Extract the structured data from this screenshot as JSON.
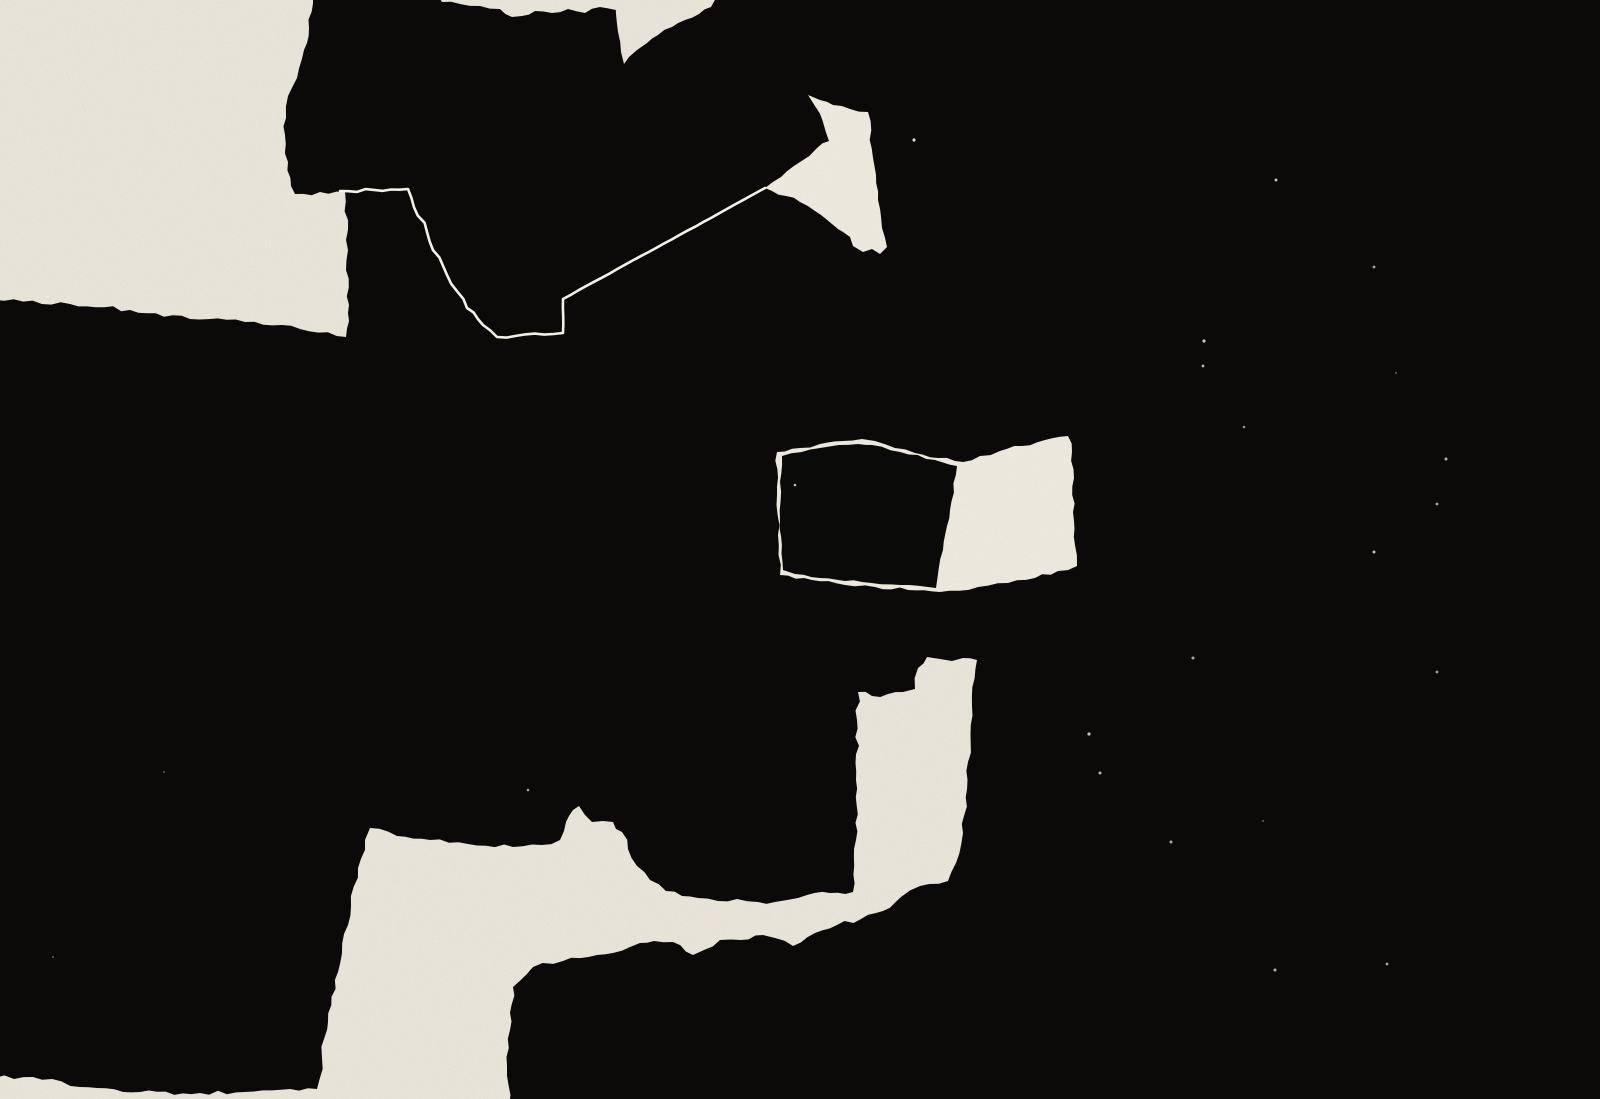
{
  "meta": {
    "title": "Abstract collage — black ink and torn cream paper",
    "canvas_width": 1600,
    "canvas_height": 1099
  },
  "artwork": {
    "background": "#0b0a08",
    "colors": {
      "cream": "#eae6db",
      "cream_bright": "#efebe0",
      "seam": "#f3f0e7",
      "ink": "#0a0a08"
    },
    "shapes": [
      {
        "name": "paper-field-top-left",
        "kind": "polygon",
        "fill": "cream",
        "rough": 2.2,
        "points": [
          [
            -5,
            -5
          ],
          [
            313,
            -5
          ],
          [
            309,
            28
          ],
          [
            304,
            50
          ],
          [
            297,
            78
          ],
          [
            288,
            96
          ],
          [
            286,
            118
          ],
          [
            285,
            135
          ],
          [
            288,
            162
          ],
          [
            291,
            186
          ],
          [
            295,
            194
          ],
          [
            345,
            192
          ],
          [
            348,
            230
          ],
          [
            346,
            270
          ],
          [
            349,
            305
          ],
          [
            346,
            337
          ],
          [
            300,
            329
          ],
          [
            245,
            322
          ],
          [
            190,
            319
          ],
          [
            130,
            310
          ],
          [
            70,
            304
          ],
          [
            -5,
            300
          ]
        ]
      },
      {
        "name": "paper-sliver-top",
        "kind": "polygon",
        "fill": "cream",
        "rough": 1.5,
        "points": [
          [
            438,
            -5
          ],
          [
            619,
            -5
          ],
          [
            616,
            10
          ],
          [
            600,
            7
          ],
          [
            585,
            13
          ],
          [
            568,
            9
          ],
          [
            552,
            13
          ],
          [
            535,
            11
          ],
          [
            522,
            16
          ],
          [
            512,
            17
          ],
          [
            500,
            9
          ],
          [
            480,
            6
          ],
          [
            460,
            4
          ],
          [
            442,
            2
          ]
        ]
      },
      {
        "name": "paper-notch-wedge",
        "kind": "polygon",
        "fill": "cream",
        "rough": 1.3,
        "points": [
          [
            614,
            -5
          ],
          [
            720,
            -5
          ],
          [
            711,
            7
          ],
          [
            699,
            14
          ],
          [
            685,
            20
          ],
          [
            672,
            27
          ],
          [
            658,
            35
          ],
          [
            647,
            43
          ],
          [
            637,
            50
          ],
          [
            629,
            57
          ],
          [
            624,
            64
          ],
          [
            621,
            52
          ],
          [
            618,
            32
          ],
          [
            616,
            14
          ]
        ]
      },
      {
        "name": "arrow-head-paper",
        "kind": "polygon",
        "fill": "cream_bright",
        "rough": 1.6,
        "points": [
          [
            808,
            95
          ],
          [
            820,
            100
          ],
          [
            833,
            105
          ],
          [
            850,
            109
          ],
          [
            868,
            112
          ],
          [
            873,
            158
          ],
          [
            878,
            200
          ],
          [
            882,
            228
          ],
          [
            887,
            247
          ],
          [
            880,
            254
          ],
          [
            872,
            249
          ],
          [
            863,
            252
          ],
          [
            853,
            246
          ],
          [
            850,
            237
          ],
          [
            838,
            229
          ],
          [
            826,
            219
          ],
          [
            815,
            211
          ],
          [
            800,
            202
          ],
          [
            786,
            196
          ],
          [
            772,
            191
          ],
          [
            765,
            188
          ],
          [
            781,
            177
          ],
          [
            800,
            162
          ],
          [
            817,
            148
          ],
          [
            829,
            141
          ],
          [
            823,
            122
          ],
          [
            815,
            106
          ]
        ]
      },
      {
        "name": "paper-middle-piece",
        "kind": "polygon",
        "fill": "cream_bright",
        "rough": 1.8,
        "points": [
          [
            777,
            452
          ],
          [
            800,
            448
          ],
          [
            820,
            444
          ],
          [
            843,
            441
          ],
          [
            862,
            439
          ],
          [
            875,
            441
          ],
          [
            895,
            448
          ],
          [
            915,
            453
          ],
          [
            938,
            458
          ],
          [
            955,
            461
          ],
          [
            963,
            462
          ],
          [
            980,
            456
          ],
          [
            1000,
            451
          ],
          [
            1022,
            446
          ],
          [
            1045,
            440
          ],
          [
            1068,
            436
          ],
          [
            1072,
            452
          ],
          [
            1074,
            478
          ],
          [
            1073,
            512
          ],
          [
            1075,
            545
          ],
          [
            1077,
            566
          ],
          [
            1058,
            571
          ],
          [
            1035,
            578
          ],
          [
            1008,
            583
          ],
          [
            978,
            587
          ],
          [
            940,
            592
          ],
          [
            908,
            590
          ],
          [
            875,
            587
          ],
          [
            845,
            585
          ],
          [
            812,
            580
          ],
          [
            780,
            575
          ],
          [
            778,
            535
          ],
          [
            777,
            495
          ]
        ]
      },
      {
        "name": "ink-block-middle",
        "kind": "polygon",
        "fill": "ink",
        "rough": 1.1,
        "points": [
          [
            782,
            456
          ],
          [
            820,
            448
          ],
          [
            858,
            444
          ],
          [
            872,
            445
          ],
          [
            900,
            452
          ],
          [
            935,
            460
          ],
          [
            957,
            466
          ],
          [
            950,
            510
          ],
          [
            943,
            550
          ],
          [
            936,
            588
          ],
          [
            900,
            585
          ],
          [
            862,
            582
          ],
          [
            820,
            578
          ],
          [
            795,
            574
          ],
          [
            783,
            570
          ],
          [
            780,
            520
          ],
          [
            780,
            482
          ]
        ]
      },
      {
        "name": "paper-bottom-mass",
        "kind": "polygon",
        "fill": "cream",
        "rough": 2.4,
        "points": [
          [
            370,
            828
          ],
          [
            397,
            836
          ],
          [
            430,
            840
          ],
          [
            468,
            844
          ],
          [
            513,
            847
          ],
          [
            542,
            845
          ],
          [
            560,
            840
          ],
          [
            566,
            822
          ],
          [
            573,
            810
          ],
          [
            579,
            806
          ],
          [
            585,
            815
          ],
          [
            592,
            822
          ],
          [
            603,
            821
          ],
          [
            613,
            822
          ],
          [
            616,
            829
          ],
          [
            622,
            832
          ],
          [
            628,
            849
          ],
          [
            637,
            866
          ],
          [
            650,
            880
          ],
          [
            666,
            891
          ],
          [
            682,
            896
          ],
          [
            698,
            898
          ],
          [
            718,
            901
          ],
          [
            737,
            899
          ],
          [
            758,
            902
          ],
          [
            775,
            902
          ],
          [
            787,
            900
          ],
          [
            798,
            898
          ],
          [
            807,
            895
          ],
          [
            830,
            893
          ],
          [
            853,
            892
          ],
          [
            856,
            840
          ],
          [
            856,
            780
          ],
          [
            857,
            720
          ],
          [
            858,
            692
          ],
          [
            872,
            696
          ],
          [
            888,
            694
          ],
          [
            903,
            692
          ],
          [
            915,
            689
          ],
          [
            918,
            668
          ],
          [
            927,
            657
          ],
          [
            940,
            659
          ],
          [
            952,
            661
          ],
          [
            963,
            658
          ],
          [
            977,
            660
          ],
          [
            972,
            706
          ],
          [
            968,
            762
          ],
          [
            963,
            833
          ],
          [
            956,
            863
          ],
          [
            948,
            881
          ],
          [
            920,
            886
          ],
          [
            901,
            897
          ],
          [
            883,
            911
          ],
          [
            861,
            919
          ],
          [
            837,
            925
          ],
          [
            815,
            933
          ],
          [
            793,
            946
          ],
          [
            775,
            938
          ],
          [
            763,
            935
          ],
          [
            741,
            940
          ],
          [
            720,
            940
          ],
          [
            704,
            950
          ],
          [
            693,
            955
          ],
          [
            673,
            942
          ],
          [
            654,
            941
          ],
          [
            640,
            943
          ],
          [
            630,
            947
          ],
          [
            597,
            955
          ],
          [
            563,
            961
          ],
          [
            533,
            967
          ],
          [
            513,
            987
          ],
          [
            510,
            1030
          ],
          [
            507,
            1066
          ],
          [
            509,
            1105
          ],
          [
            -5,
            1105
          ],
          [
            -5,
            1078
          ],
          [
            33,
            1077
          ],
          [
            80,
            1087
          ],
          [
            140,
            1092
          ],
          [
            200,
            1093
          ],
          [
            245,
            1092
          ],
          [
            290,
            1089
          ],
          [
            317,
            1089
          ],
          [
            322,
            1058
          ],
          [
            325,
            1036
          ],
          [
            328,
            1022
          ],
          [
            338,
            972
          ],
          [
            348,
            925
          ],
          [
            358,
            868
          ],
          [
            365,
            840
          ]
        ]
      },
      {
        "name": "seam-outline-line",
        "kind": "polyline",
        "stroke": "seam",
        "width": 2.6,
        "rough": 1.2,
        "edges": [
          1.5,
          2.5,
          2.5,
          2.5,
          2.2,
          1.8,
          1.2,
          0.5,
          0.3
        ],
        "points": [
          [
            340,
            191
          ],
          [
            408,
            189
          ],
          [
            427,
            232
          ],
          [
            447,
            275
          ],
          [
            467,
            308
          ],
          [
            483,
            325
          ],
          [
            497,
            337
          ],
          [
            563,
            333
          ],
          [
            563,
            299
          ],
          [
            765,
            188
          ]
        ]
      }
    ],
    "specks": [
      {
        "x": 914,
        "y": 140,
        "r": 1.6,
        "o": 0.9
      },
      {
        "x": 1276,
        "y": 180,
        "r": 1.5,
        "o": 0.8
      },
      {
        "x": 1374,
        "y": 267,
        "r": 1.4,
        "o": 0.7
      },
      {
        "x": 1204,
        "y": 341,
        "r": 1.6,
        "o": 0.85
      },
      {
        "x": 1203,
        "y": 366,
        "r": 1.4,
        "o": 0.8
      },
      {
        "x": 1244,
        "y": 427,
        "r": 1.3,
        "o": 0.6
      },
      {
        "x": 1446,
        "y": 459,
        "r": 1.5,
        "o": 0.75
      },
      {
        "x": 1437,
        "y": 504,
        "r": 1.4,
        "o": 0.7
      },
      {
        "x": 1374,
        "y": 552,
        "r": 1.5,
        "o": 0.8
      },
      {
        "x": 1396,
        "y": 373,
        "r": 1.0,
        "o": 0.4
      },
      {
        "x": 1193,
        "y": 658,
        "r": 1.5,
        "o": 0.7
      },
      {
        "x": 1437,
        "y": 672,
        "r": 1.4,
        "o": 0.65
      },
      {
        "x": 1089,
        "y": 734,
        "r": 1.6,
        "o": 0.8
      },
      {
        "x": 1100,
        "y": 773,
        "r": 1.5,
        "o": 0.75
      },
      {
        "x": 1171,
        "y": 842,
        "r": 1.5,
        "o": 0.7
      },
      {
        "x": 1263,
        "y": 821,
        "r": 1.0,
        "o": 0.4
      },
      {
        "x": 1387,
        "y": 964,
        "r": 1.4,
        "o": 0.7
      },
      {
        "x": 1275,
        "y": 970,
        "r": 1.5,
        "o": 0.75
      },
      {
        "x": 795,
        "y": 485,
        "r": 1.3,
        "o": 0.8
      },
      {
        "x": 528,
        "y": 790,
        "r": 1.3,
        "o": 0.7
      },
      {
        "x": 53,
        "y": 957,
        "r": 1.0,
        "o": 0.4
      },
      {
        "x": 164,
        "y": 772,
        "r": 1.0,
        "o": 0.35
      }
    ]
  }
}
